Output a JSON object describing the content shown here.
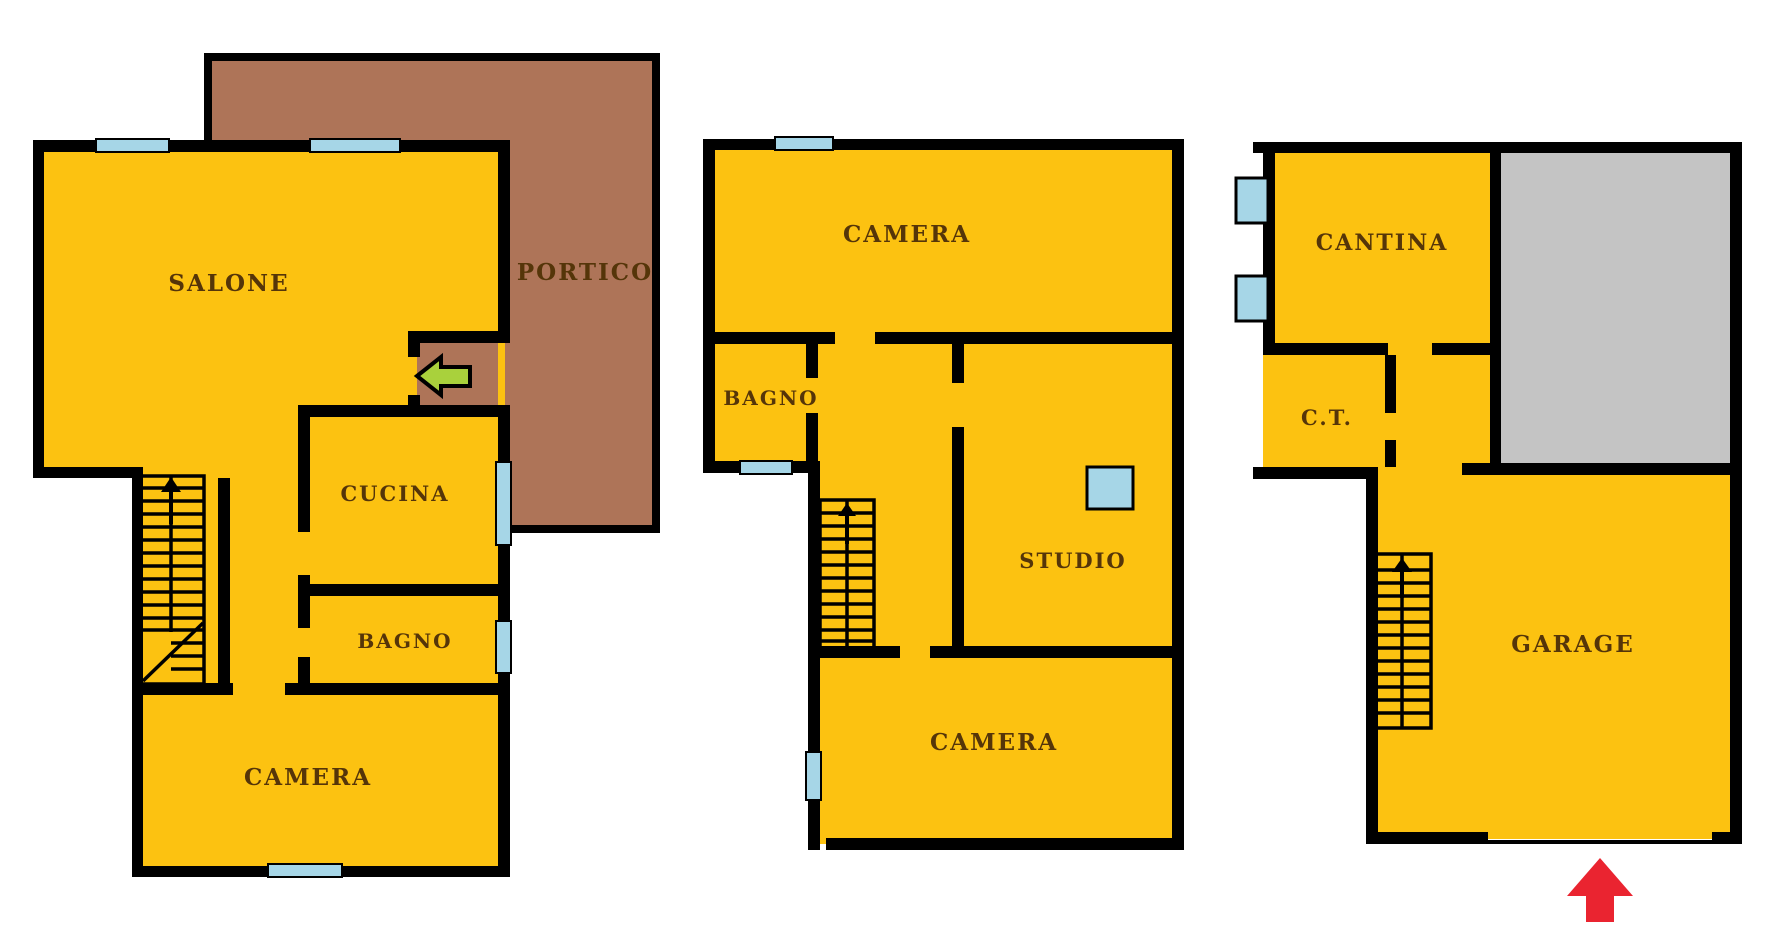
{
  "canvas": {
    "background": "#ffffff"
  },
  "colors": {
    "wall": "#000000",
    "floor": "#fcc211",
    "portico": "#ae7458",
    "window": "#a6d6e7",
    "gray_area": "#c4c4c4",
    "label": "#553509",
    "entrance_arrow_green": "#a9d13c",
    "entrance_arrow_red": "#ea2430"
  },
  "plans": {
    "ground": {
      "rooms": {
        "salone": "SALONE",
        "portico": "PORTICO",
        "cucina": "CUCINA",
        "bagno": "BAGNO",
        "camera": "CAMERA"
      }
    },
    "first": {
      "rooms": {
        "camera_top": "CAMERA",
        "bagno": "BAGNO",
        "studio": "STUDIO",
        "camera_bottom": "CAMERA"
      }
    },
    "basement": {
      "rooms": {
        "cantina": "CANTINA",
        "ct": "C.T.",
        "garage": "GARAGE"
      }
    }
  },
  "icons": {
    "stairs": "stairs-up-icon",
    "window": "window-icon",
    "ground_entrance": "entrance-arrow-left-icon",
    "garage_entrance": "entrance-arrow-up-icon"
  }
}
